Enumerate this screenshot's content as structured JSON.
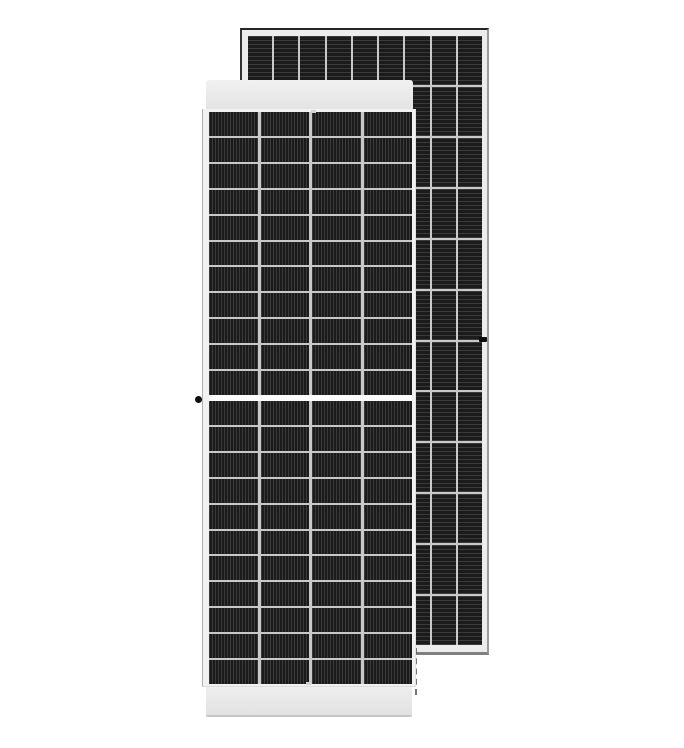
{
  "meta": {
    "description": "Product photo of two framed monocrystalline solar panels standing upright on a plain white background, front panel overlapping a taller rear panel",
    "text_content": "none — image contains no visible text"
  },
  "colors": {
    "background": "#ffffff",
    "frame_light": "#ececec",
    "cell_base": "#1b1b1b",
    "cell_line": "#3a3a3a",
    "gap_light": "#c9c9c9",
    "divider_white": "#fbfbfb",
    "edge_dark": "#262626",
    "edge_gray": "#9a9a9a",
    "dot_black": "#0d0d0d",
    "dash_gray": "#5f5f5f"
  },
  "panels": {
    "back": {
      "label": "rear solar panel, front face visible",
      "columns": 9,
      "rows": 12,
      "cell_texture": "horizontal-stripes",
      "grounding_hole": "right frame, mid height"
    },
    "front": {
      "label": "front solar panel, rear face visible",
      "columns": 4,
      "rows_per_half": 11,
      "halves": 2,
      "cell_texture": "vertical-stripes",
      "center_divider": true,
      "grounding_hole": "left frame, mid height",
      "top_rail": true,
      "bottom_rail": true
    }
  }
}
